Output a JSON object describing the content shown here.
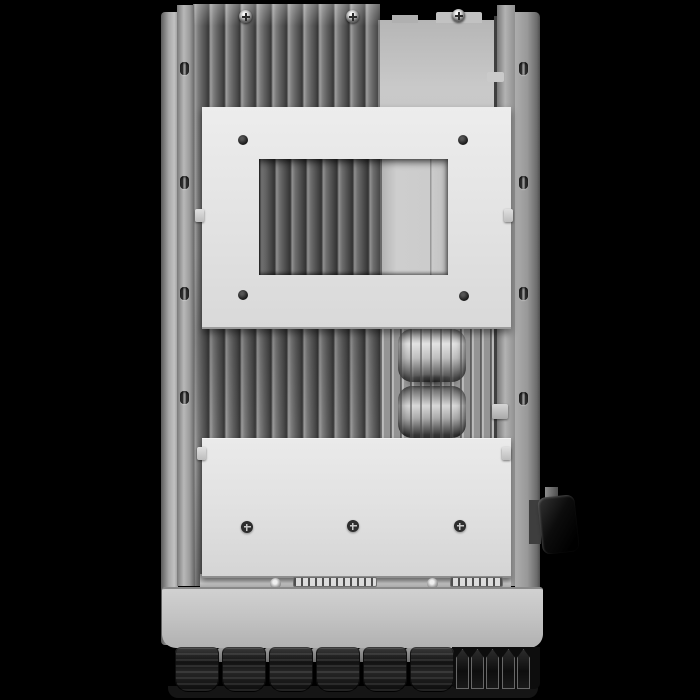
{
  "meta": {
    "subject": "rear-view product photo of a wall-mount hybrid solar inverter heatsink side",
    "background_color": "#000000"
  },
  "colors": {
    "background": "#000000",
    "bracket_plate": "#e3e3e3",
    "heatsink_fin_dark": "#5d5d5d",
    "heatsink_fin_ridge": "#9e9e9e",
    "inner_panel": "#c6c6c6",
    "side_rail": "#9e9e9e",
    "front_face": "#c4c4c4",
    "connector_black": "#1a1a1a",
    "dc_switch_black": "#0d0d0d",
    "coil_highlight": "#e0e0e0"
  },
  "structure": {
    "heatsink_fin_count": 12,
    "light_fin_count": 11,
    "cable_gland_count": 6,
    "pv_connector_count": 5,
    "rail_hole_count_per_side": 4,
    "coil_count": 2,
    "upper_bracket_screw_count": 4,
    "lower_bracket_screw_count": 3
  },
  "parts": {
    "left_rail_holes": {
      "x": 180,
      "y": [
        62,
        176,
        287,
        391
      ]
    },
    "right_rail_holes": {
      "x": 519,
      "y": [
        62,
        176,
        287,
        392
      ]
    },
    "top_screws": [
      [
        246,
        17
      ],
      [
        353,
        17
      ],
      [
        459,
        16
      ]
    ],
    "upper_bracket_screws": [
      [
        243,
        140
      ],
      [
        463,
        140
      ],
      [
        243,
        295
      ],
      [
        464,
        296
      ]
    ],
    "lower_bracket_screws": [
      [
        247,
        527
      ],
      [
        353,
        526
      ],
      [
        460,
        526
      ]
    ],
    "clamp_screws": [
      [
        275,
        583
      ],
      [
        432,
        583
      ]
    ],
    "terminal_blocks": [
      [
        293,
        577,
        84
      ],
      [
        450,
        577,
        53
      ]
    ],
    "gap_tab_xs": [
      218,
      265,
      312,
      359,
      406
    ],
    "gland_xs": [
      175,
      222,
      269,
      316,
      363,
      410
    ],
    "mc4_xs": [
      456,
      471,
      486,
      502,
      517
    ]
  }
}
